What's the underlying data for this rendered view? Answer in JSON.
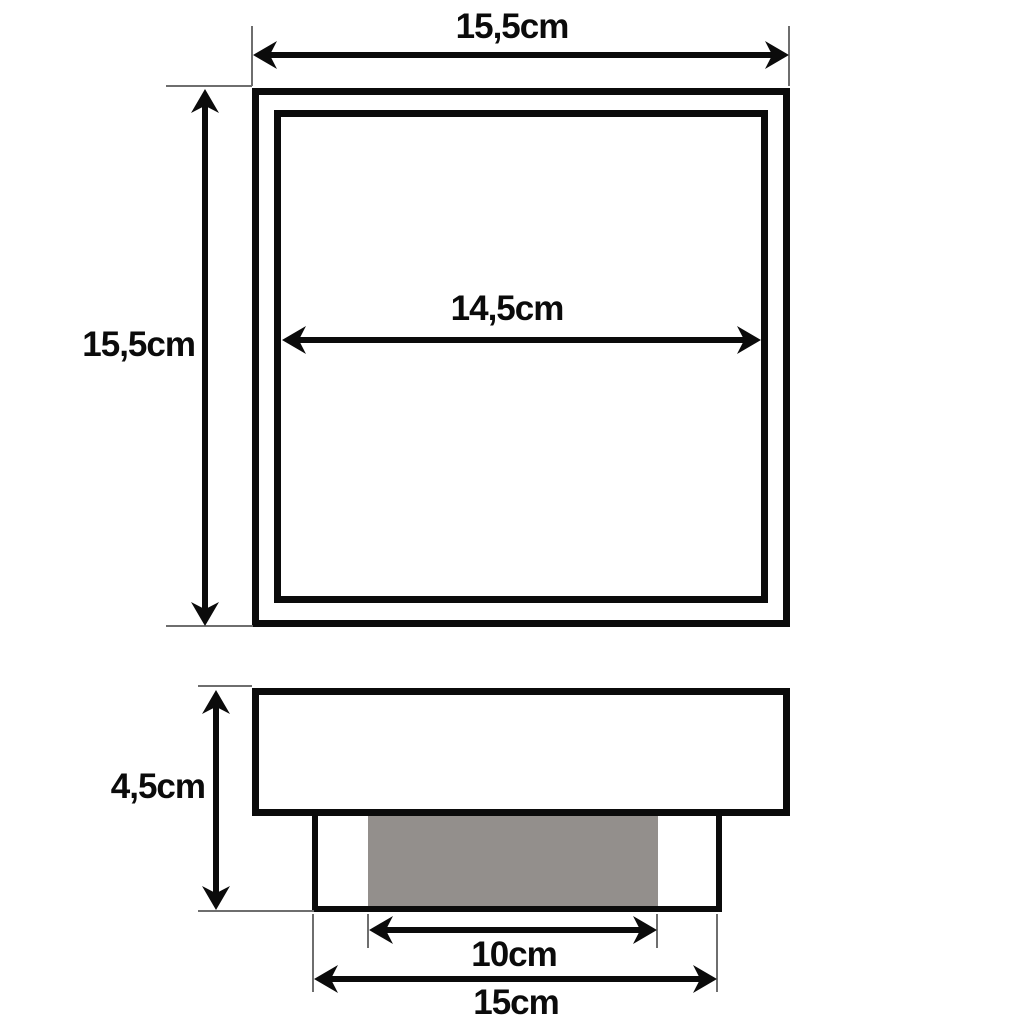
{
  "diagram": {
    "title": "product-dimension-drawing",
    "top_view": {
      "outer_width_label": "15,5cm",
      "outer_height_label": "15,5cm",
      "inner_width_label": "14,5cm"
    },
    "side_view": {
      "height_label": "4,5cm",
      "recess_width_label": "10cm",
      "base_width_label": "15cm"
    },
    "colors": {
      "line": "#0b0b0b",
      "fill_gray": "#938f8c",
      "extension_line": "#6e6e6e",
      "background": "#ffffff"
    }
  }
}
